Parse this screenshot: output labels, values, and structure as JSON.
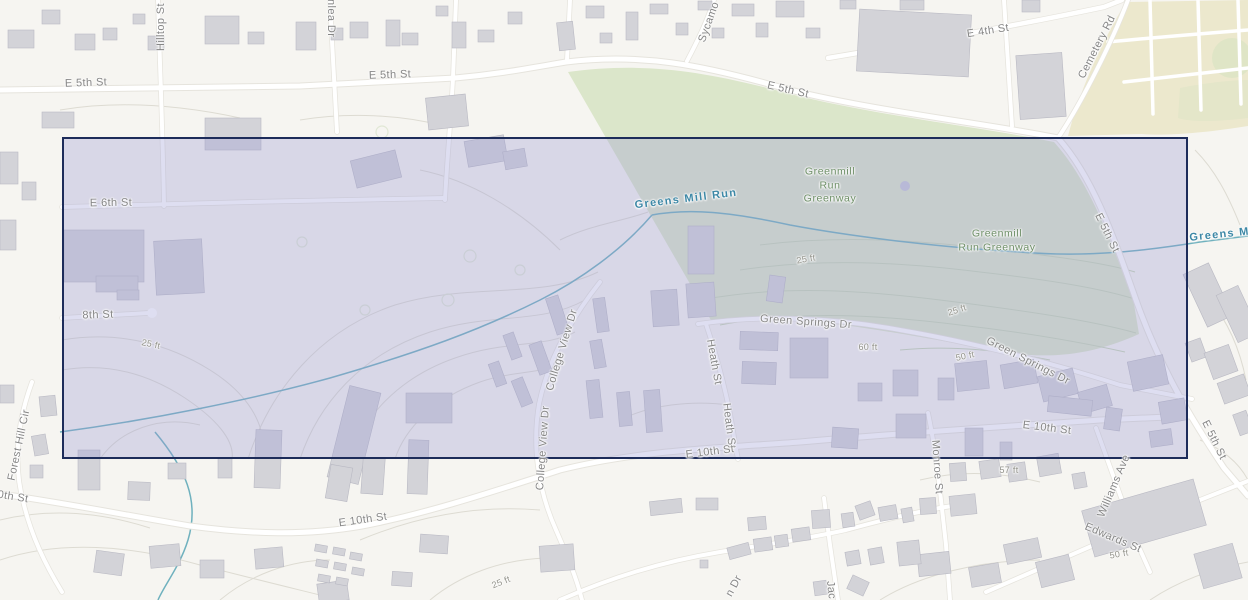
{
  "map": {
    "selection": {
      "x": 62,
      "y": 137,
      "width": 1126,
      "height": 322
    },
    "colors": {
      "background": "#f6f5f1",
      "road_fill": "#ffffff",
      "road_casing": "#e6e4dd",
      "building": "#d3d3d8",
      "greenway_fill": "#dbe6ca",
      "cemetery_fill": "#ece8cd",
      "water_line": "#6fb1be",
      "contour_line": "#dddbd2",
      "selection_border": "#1d2c5a",
      "selection_fill": "rgba(156,156,212,0.33)",
      "street_label": "#868686",
      "water_label": "#3d88a6",
      "park_label": "#6d8e66",
      "contour_label": "#92928a"
    },
    "labels": [
      {
        "text": "E 5th St",
        "x": 86,
        "y": 83,
        "rot": -2,
        "kind": "street"
      },
      {
        "text": "E 5th St",
        "x": 390,
        "y": 75,
        "rot": -2,
        "kind": "street"
      },
      {
        "text": "E 5th St",
        "x": 788,
        "y": 90,
        "rot": 13,
        "kind": "street"
      },
      {
        "text": "E 4th St",
        "x": 988,
        "y": 31,
        "rot": -9,
        "kind": "street"
      },
      {
        "text": "Cemetery Rd",
        "x": 1097,
        "y": 47,
        "rot": -63,
        "kind": "street"
      },
      {
        "text": "Hilltop St",
        "x": 161,
        "y": 27,
        "rot": -90,
        "kind": "street"
      },
      {
        "text": "wnlea Dr",
        "x": 331,
        "y": 14,
        "rot": 90,
        "kind": "street"
      },
      {
        "text": "Sycamo",
        "x": 709,
        "y": 22,
        "rot": -70,
        "kind": "street"
      },
      {
        "text": "E 6th St",
        "x": 111,
        "y": 203,
        "rot": -1,
        "kind": "street"
      },
      {
        "text": "8th St",
        "x": 98,
        "y": 315,
        "rot": -2,
        "kind": "street"
      },
      {
        "text": "Greens Mill Run",
        "x": 686,
        "y": 199,
        "rot": -7,
        "kind": "water"
      },
      {
        "text": "Greens Mill",
        "x": 1226,
        "y": 234,
        "rot": -6,
        "kind": "water"
      },
      {
        "text": "Greenmill\nRun\nGreenway",
        "x": 830,
        "y": 186,
        "rot": 0,
        "kind": "park"
      },
      {
        "text": "Greenmill\nRun Greenway",
        "x": 997,
        "y": 241,
        "rot": 0,
        "kind": "park"
      },
      {
        "text": "E 5th St",
        "x": 1107,
        "y": 233,
        "rot": 64,
        "kind": "street"
      },
      {
        "text": "Green Springs Dr",
        "x": 806,
        "y": 322,
        "rot": 4,
        "kind": "street"
      },
      {
        "text": "Green Springs Dr",
        "x": 1028,
        "y": 361,
        "rot": 27,
        "kind": "street"
      },
      {
        "text": "College View Dr",
        "x": 562,
        "y": 350,
        "rot": -73,
        "kind": "street"
      },
      {
        "text": "College View Dr",
        "x": 543,
        "y": 448,
        "rot": -86,
        "kind": "street"
      },
      {
        "text": "Heath St",
        "x": 714,
        "y": 362,
        "rot": 80,
        "kind": "street"
      },
      {
        "text": "Heath St",
        "x": 729,
        "y": 426,
        "rot": 83,
        "kind": "street"
      },
      {
        "text": "E 10th St",
        "x": 710,
        "y": 452,
        "rot": -7,
        "kind": "street"
      },
      {
        "text": "E 10th St",
        "x": 363,
        "y": 520,
        "rot": -8,
        "kind": "street"
      },
      {
        "text": "E 10th St",
        "x": 1047,
        "y": 428,
        "rot": 7,
        "kind": "street"
      },
      {
        "text": "Monroe St",
        "x": 937,
        "y": 467,
        "rot": 86,
        "kind": "street"
      },
      {
        "text": "Williams Ave",
        "x": 1114,
        "y": 486,
        "rot": -67,
        "kind": "street"
      },
      {
        "text": "Edwards St",
        "x": 1113,
        "y": 538,
        "rot": 23,
        "kind": "street"
      },
      {
        "text": "Forest Hill Cir",
        "x": 19,
        "y": 445,
        "rot": -78,
        "kind": "street"
      },
      {
        "text": "0th St",
        "x": 13,
        "y": 497,
        "rot": 9,
        "kind": "street"
      },
      {
        "text": "E 5th St",
        "x": 1214,
        "y": 440,
        "rot": 64,
        "kind": "street"
      },
      {
        "text": "n Dr",
        "x": 734,
        "y": 586,
        "rot": -62,
        "kind": "street"
      },
      {
        "text": "Jac",
        "x": 831,
        "y": 590,
        "rot": 84,
        "kind": "street"
      },
      {
        "text": "25 ft",
        "x": 806,
        "y": 259,
        "rot": -10,
        "kind": "contour"
      },
      {
        "text": "25 ft",
        "x": 957,
        "y": 310,
        "rot": -18,
        "kind": "contour"
      },
      {
        "text": "60 ft",
        "x": 868,
        "y": 347,
        "rot": 0,
        "kind": "contour"
      },
      {
        "text": "50 ft",
        "x": 965,
        "y": 356,
        "rot": -12,
        "kind": "contour"
      },
      {
        "text": "57 ft",
        "x": 1009,
        "y": 470,
        "rot": 0,
        "kind": "contour"
      },
      {
        "text": "25 ft",
        "x": 151,
        "y": 344,
        "rot": 12,
        "kind": "contour"
      },
      {
        "text": "25 ft",
        "x": 501,
        "y": 582,
        "rot": -22,
        "kind": "contour"
      },
      {
        "text": "50 ft",
        "x": 1119,
        "y": 554,
        "rot": -10,
        "kind": "contour"
      }
    ]
  }
}
